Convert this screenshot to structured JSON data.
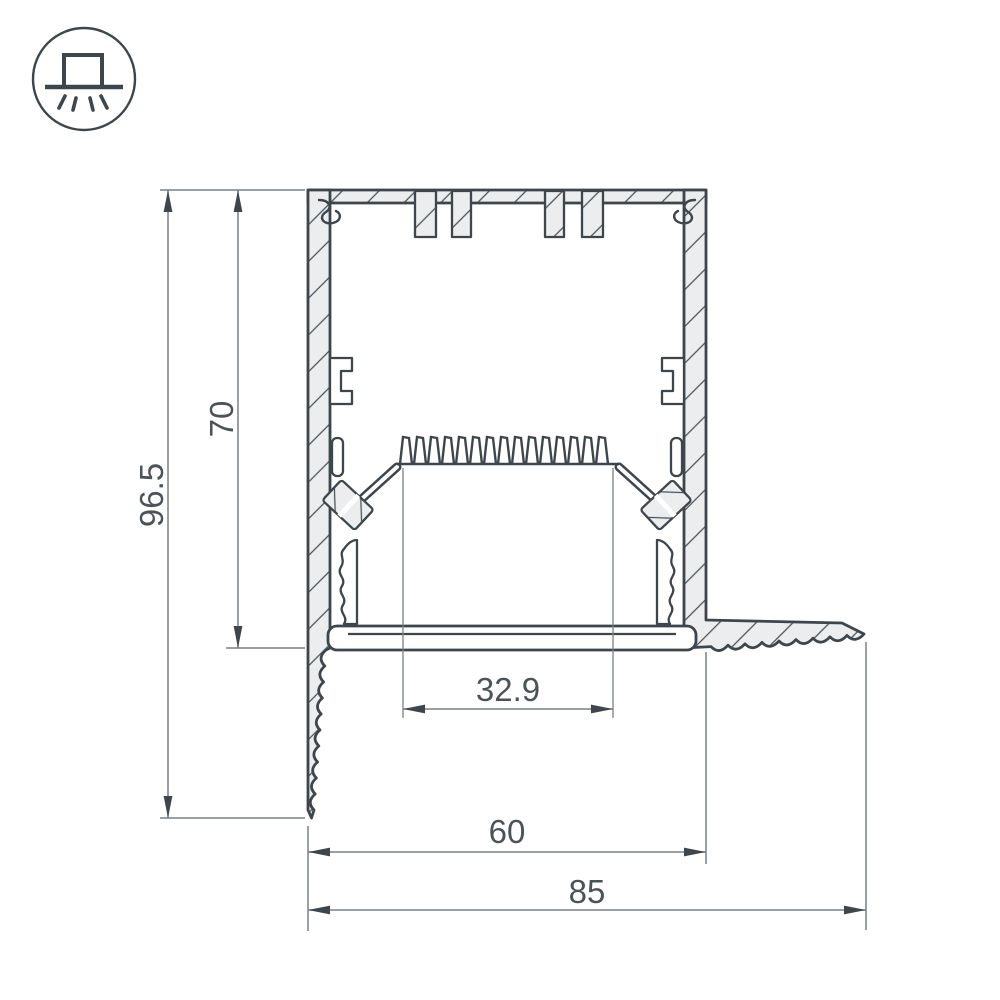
{
  "icon": {
    "name": "surface-mounted-luminaire"
  },
  "dimensions": {
    "overall_height": "96.5",
    "inner_height": "70",
    "led_window_width": "32.9",
    "body_width": "60",
    "overall_width": "85"
  },
  "colors": {
    "outline": "#3e464b",
    "profile_fill": "#ebedee",
    "dimension_line": "#7c8185",
    "dimension_text": "#4c5357",
    "background": "#ffffff"
  }
}
